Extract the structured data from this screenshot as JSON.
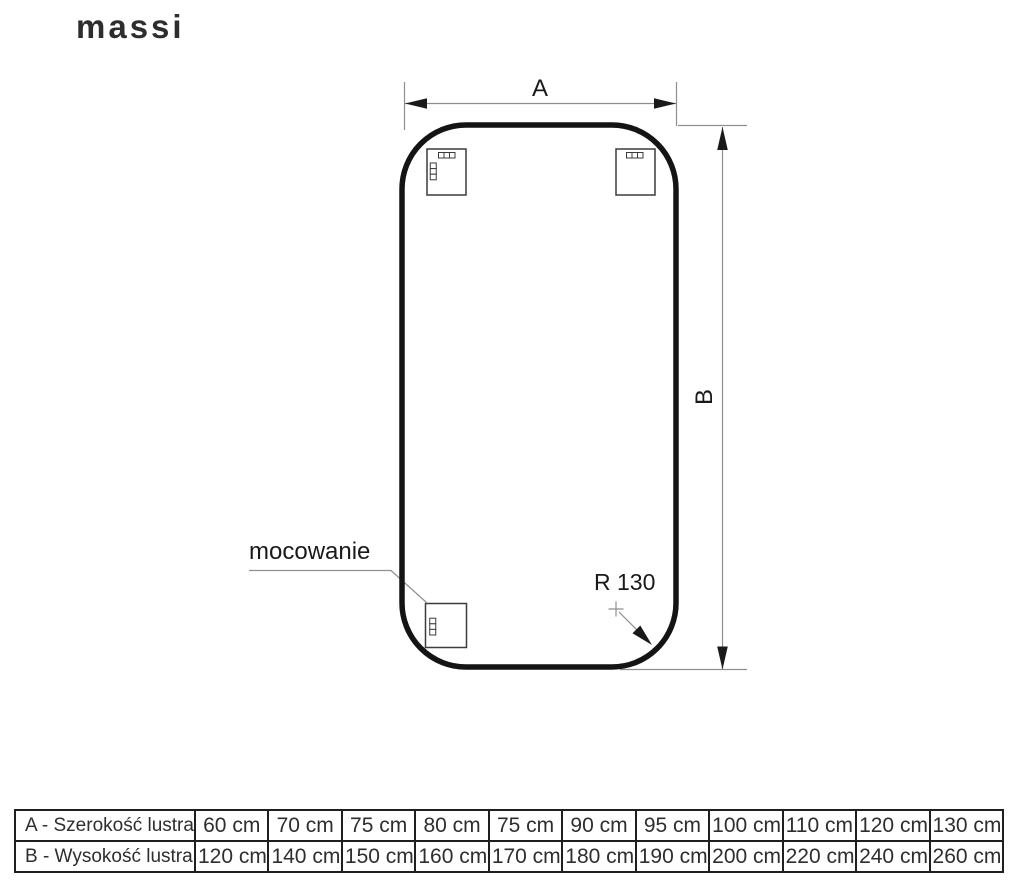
{
  "brand": {
    "logo_text": "massi"
  },
  "diagram": {
    "width_dim_label": "A",
    "height_dim_label": "B",
    "mounting_label": "mocowanie",
    "corner_radius_label": "R 130"
  },
  "colors": {
    "outline": "#141414",
    "thin": "#8f8f8f",
    "ink": "#1a1a1a",
    "table-border": "#1f1f1f",
    "table-text": "#2e2e2e",
    "logo": "#2d2d2d"
  },
  "table": {
    "rows": [
      {
        "label": "A - Szerokość lustra",
        "values": [
          "60 cm",
          "70 cm",
          "75 cm",
          "80 cm",
          "75 cm",
          "90 cm",
          "95 cm",
          "100 cm",
          "110 cm",
          "120 cm",
          "130 cm"
        ]
      },
      {
        "label": "B - Wysokość lustra",
        "values": [
          "120 cm",
          "140 cm",
          "150 cm",
          "160 cm",
          "170 cm",
          "180 cm",
          "190 cm",
          "200 cm",
          "220 cm",
          "240 cm",
          "260 cm"
        ]
      }
    ]
  }
}
